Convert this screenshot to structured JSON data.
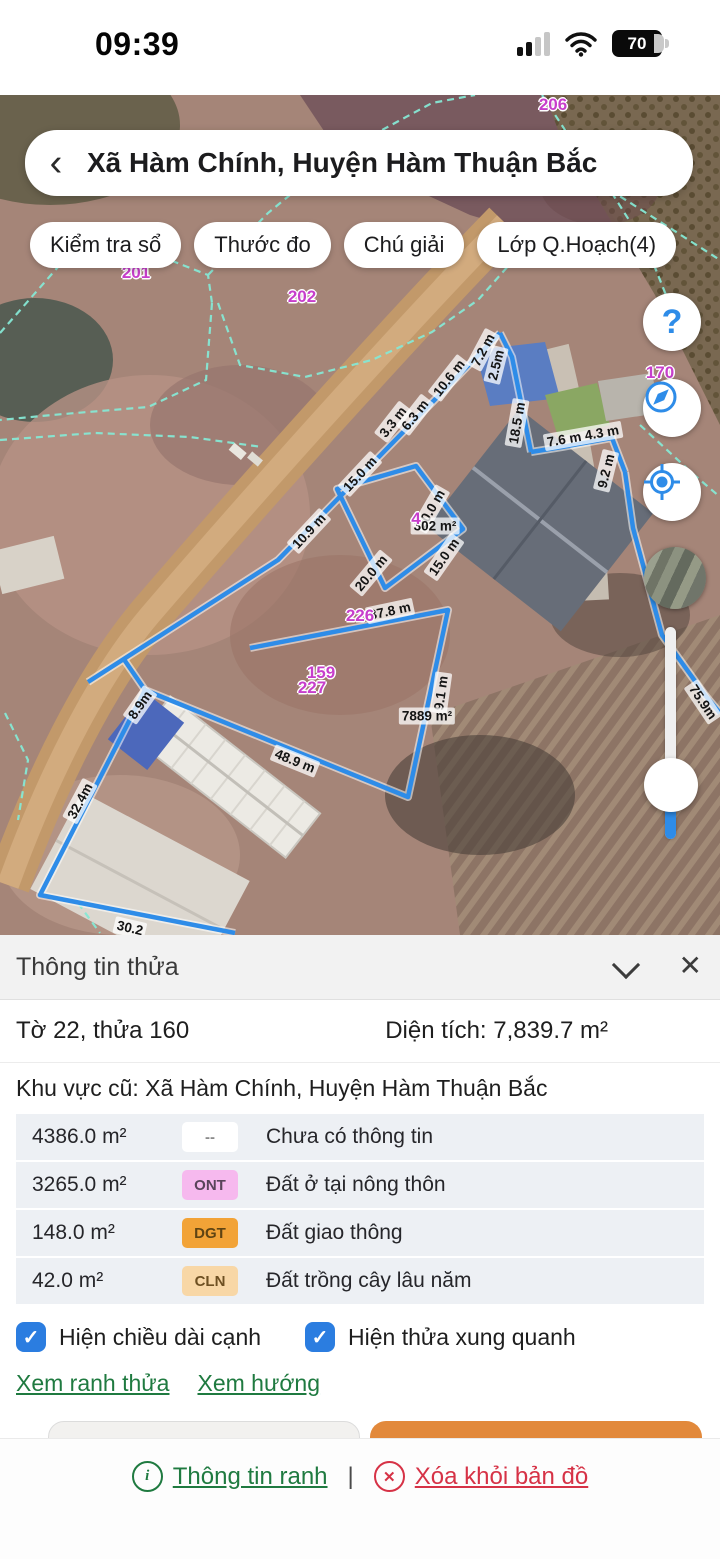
{
  "status_bar": {
    "time": "09:39",
    "battery_level": "70"
  },
  "header": {
    "back_glyph": "‹",
    "title": "Xã Hàm Chính, Huyện Hàm Thuận Bắc"
  },
  "toolbar": {
    "buttons": [
      "Kiểm tra sổ",
      "Thước đo",
      "Chú giải",
      "Lớp Q.Hoạch(4)"
    ]
  },
  "map": {
    "help_glyph": "?",
    "labels": [
      {
        "text": "7.2 m",
        "kind": "measure",
        "x": 483,
        "y": 255,
        "rot": -62
      },
      {
        "text": "2.5m",
        "kind": "measure",
        "x": 496,
        "y": 270,
        "rot": -76
      },
      {
        "text": "10.6 m",
        "kind": "measure",
        "x": 449,
        "y": 283,
        "rot": -52
      },
      {
        "text": "3.3 m",
        "kind": "measure",
        "x": 393,
        "y": 327,
        "rot": -52
      },
      {
        "text": "6.3 m",
        "kind": "measure",
        "x": 415,
        "y": 320,
        "rot": -52
      },
      {
        "text": "18.5 m",
        "kind": "measure",
        "x": 517,
        "y": 328,
        "rot": -80
      },
      {
        "text": "7.6 m 4.3 m",
        "kind": "measure",
        "x": 583,
        "y": 341,
        "rot": -10
      },
      {
        "text": "9.2 m",
        "kind": "measure",
        "x": 606,
        "y": 376,
        "rot": -76
      },
      {
        "text": "15.0 m",
        "kind": "measure",
        "x": 360,
        "y": 379,
        "rot": -47
      },
      {
        "text": "10.9 m",
        "kind": "measure",
        "x": 309,
        "y": 436,
        "rot": -47
      },
      {
        "text": "20.0 m",
        "kind": "measure",
        "x": 431,
        "y": 414,
        "rot": -60
      },
      {
        "text": "15.0 m",
        "kind": "measure",
        "x": 444,
        "y": 462,
        "rot": -55
      },
      {
        "text": "20.0 m",
        "kind": "measure",
        "x": 371,
        "y": 478,
        "rot": -50
      },
      {
        "text": "37.8 m",
        "kind": "measure",
        "x": 390,
        "y": 516,
        "rot": -12
      },
      {
        "text": "9.1 m",
        "kind": "measure",
        "x": 441,
        "y": 598,
        "rot": -82
      },
      {
        "text": "302 m²",
        "kind": "measure",
        "x": 435,
        "y": 431,
        "rot": 0
      },
      {
        "text": "7889 m²",
        "kind": "measure",
        "x": 427,
        "y": 621,
        "rot": 0
      },
      {
        "text": "8.9m",
        "kind": "measure",
        "x": 140,
        "y": 610,
        "rot": -55
      },
      {
        "text": "48.9 m",
        "kind": "measure",
        "x": 295,
        "y": 666,
        "rot": 22
      },
      {
        "text": "32.4m",
        "kind": "measure",
        "x": 80,
        "y": 706,
        "rot": -62
      },
      {
        "text": "30.2",
        "kind": "measure",
        "x": 130,
        "y": 833,
        "rot": 13
      },
      {
        "text": "75.9m",
        "kind": "measure",
        "x": 703,
        "y": 607,
        "rot": 56
      },
      {
        "text": "206",
        "kind": "id",
        "x": 553,
        "y": 10,
        "rot": 0
      },
      {
        "text": "201",
        "kind": "id",
        "x": 136,
        "y": 178,
        "rot": 0
      },
      {
        "text": "202",
        "kind": "id",
        "x": 302,
        "y": 202,
        "rot": 0
      },
      {
        "text": "170",
        "kind": "id",
        "x": 660,
        "y": 278,
        "rot": 0
      },
      {
        "text": "4",
        "kind": "id",
        "x": 416,
        "y": 424,
        "rot": 0
      },
      {
        "text": "226",
        "kind": "id",
        "x": 360,
        "y": 521,
        "rot": 0
      },
      {
        "text": "159",
        "kind": "id",
        "x": 321,
        "y": 578,
        "rot": 0
      },
      {
        "text": "227",
        "kind": "id",
        "x": 312,
        "y": 593,
        "rot": 0
      }
    ]
  },
  "panel": {
    "title": "Thông tin thửa",
    "close_glyph": "✕",
    "check_glyph": "✓",
    "sheet_parcel": "Tờ 22, thửa 160",
    "area_text": "Diện tích: 7,839.7 m²",
    "region_text": "Khu vực cũ: Xã Hàm Chính, Huyện Hàm Thuận Bắc",
    "land_rows": [
      {
        "area": "4386.0 m²",
        "code": "--",
        "badge_bg": "#ffffff",
        "badge_color": "#8a8a8a",
        "desc": "Chưa có thông tin"
      },
      {
        "area": "3265.0 m²",
        "code": "ONT",
        "badge_bg": "#f6b9ee",
        "badge_color": "#59445a",
        "desc": "Đất ở tại nông thôn"
      },
      {
        "area": "148.0 m²",
        "code": "DGT",
        "badge_bg": "#f2a337",
        "badge_color": "#5f4413",
        "desc": "Đất giao thông"
      },
      {
        "area": "42.0 m²",
        "code": "CLN",
        "badge_bg": "#f8d7a6",
        "badge_color": "#6e5022",
        "desc": "Đất trồng cây lâu năm"
      }
    ],
    "checkboxes": [
      {
        "label": "Hiện chiều dài cạnh",
        "checked": true
      },
      {
        "label": "Hiện thửa xung quanh",
        "checked": true
      }
    ],
    "links": [
      "Xem ranh thửa",
      "Xem hướng"
    ]
  },
  "footer": {
    "info_icon_glyph": "i",
    "info_label": "Thông tin ranh",
    "separator": "|",
    "delete_icon_glyph": "✕",
    "delete_label": "Xóa khỏi bản đồ"
  },
  "colors": {
    "measure_line": "#2e8ce8",
    "cadastral_line": "#86e8d4",
    "parcel_id": "#c73ecb",
    "link_green": "#1f7a40",
    "danger_red": "#d63246",
    "checkbox_blue": "#2b7de0",
    "orange_button": "#e2893b"
  }
}
